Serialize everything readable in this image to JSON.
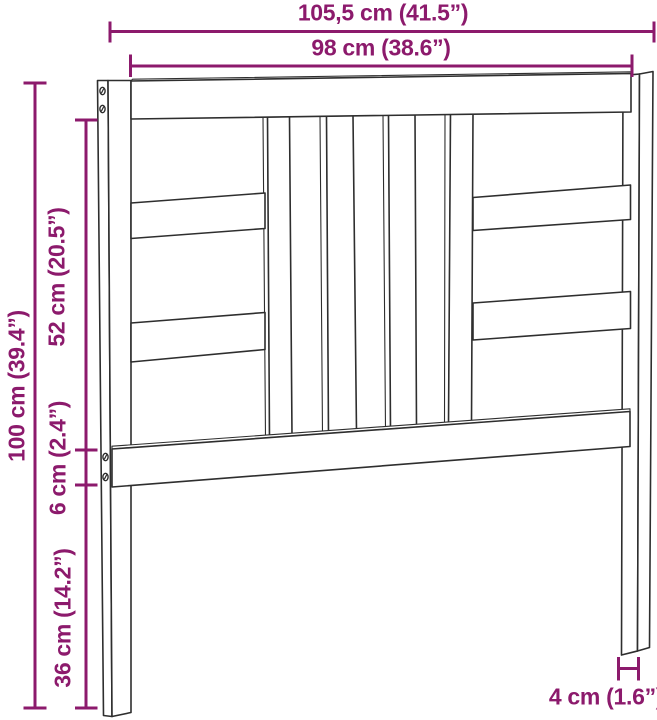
{
  "diagram": {
    "product": "headboard",
    "view": "front perspective line drawing with dimension callouts",
    "labels": {
      "total_width": "105,5 cm (41.5”)",
      "inner_width": "98 cm (38.6”)",
      "total_height": "100 cm (39.4”)",
      "upper_section_height": "52 cm (20.5”)",
      "rail_thickness": "6 cm (2.4”)",
      "leg_height": "36 cm (14.2”)",
      "leg_width": "4 cm (1.6”)"
    },
    "colors": {
      "dimension": "#8C1A6C",
      "line": "#2E2E2E",
      "background": "#FFFFFF"
    }
  }
}
